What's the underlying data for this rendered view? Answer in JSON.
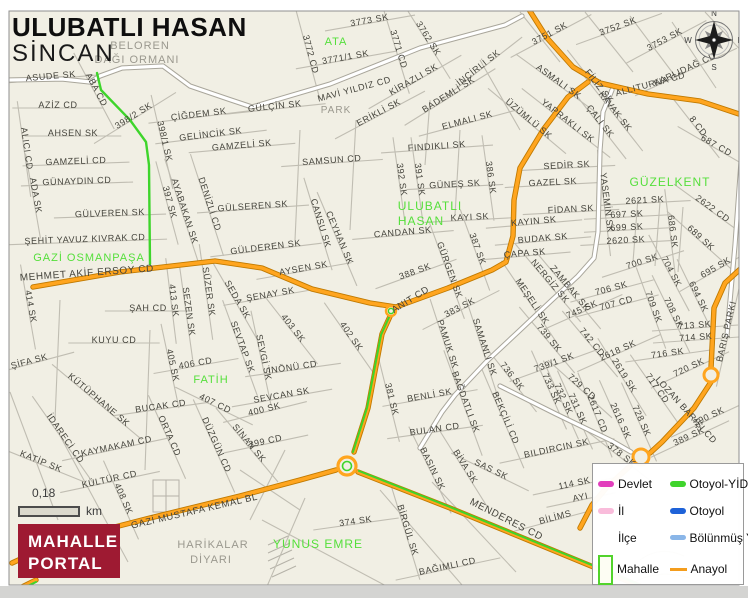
{
  "header": {
    "title": "ULUBATLI HASAN",
    "district": "SİNCAN"
  },
  "scalebar": {
    "distance": "0,18",
    "unit": "km"
  },
  "logo": {
    "line1": "MAHALLE",
    "line2": "PORTAL",
    "background": "#9e1a32"
  },
  "compass": {
    "north": "N",
    "east": "E",
    "south": "S",
    "west": "W"
  },
  "legend": {
    "items": [
      {
        "label": "Devlet",
        "color": "#e23ebc"
      },
      {
        "label": "Otoyol-YİD",
        "color": "#3fd42c"
      },
      {
        "label": "İl",
        "color": "#f9bcdb"
      },
      {
        "label": "Otoyol",
        "color": "#1e62d8"
      },
      {
        "label": "İlçe",
        "color": "#ffffff"
      },
      {
        "label": "Bölünmüş Y",
        "color": "#8ab6e8"
      },
      {
        "label": "Mahalle",
        "color": "#52d32c"
      },
      {
        "label": "Anayol",
        "color": "#f49d1d"
      }
    ]
  },
  "map": {
    "colors": {
      "background": "#f1efe4",
      "street": "#c0bdb2",
      "road_main": "#ffa51f",
      "road_main_casing": "#c07a00",
      "road_yid": "#3ed52b",
      "road_white": "#ffffff",
      "road_white_casing": "#a9a69b",
      "label": "#45443c",
      "label_area": "#55df3b",
      "label_terrain": "#9a988e"
    },
    "labels": [
      {
        "t": "BELOREN",
        "x": 140,
        "y": 49,
        "k": "terrain",
        "s": 11
      },
      {
        "t": "DAĞI ORMANI",
        "x": 137,
        "y": 63,
        "k": "terrain",
        "s": 11
      },
      {
        "t": "3773 SK",
        "x": 370,
        "y": 23,
        "r": -10
      },
      {
        "t": "3772 CD",
        "x": 308,
        "y": 55,
        "r": 75
      },
      {
        "t": "ATA",
        "x": 336,
        "y": 45,
        "k": "area",
        "s": 11
      },
      {
        "t": "3771/1 SK",
        "x": 346,
        "y": 60,
        "r": -10
      },
      {
        "t": "3771 CD",
        "x": 396,
        "y": 50,
        "r": 73
      },
      {
        "t": "3762 SK",
        "x": 426,
        "y": 40,
        "r": 58
      },
      {
        "t": "3751 SK",
        "x": 551,
        "y": 36,
        "r": -28
      },
      {
        "t": "3752 SK",
        "x": 619,
        "y": 29,
        "r": -20
      },
      {
        "t": "3753 SK",
        "x": 666,
        "y": 42,
        "r": -28
      },
      {
        "t": "KARLIDAĞ CD",
        "x": 686,
        "y": 72,
        "r": -25
      },
      {
        "t": "ALLITURNA CD",
        "x": 651,
        "y": 87,
        "r": -15,
        "k": "road"
      },
      {
        "t": "ASUDE SK",
        "x": 51,
        "y": 79,
        "r": -5
      },
      {
        "t": "ABA CD",
        "x": 94,
        "y": 91,
        "r": 62
      },
      {
        "t": "MAVİ YILDIZ CD",
        "x": 355,
        "y": 92,
        "r": -15,
        "k": "road"
      },
      {
        "t": "KİRAZLI SK",
        "x": 415,
        "y": 82,
        "r": -30
      },
      {
        "t": "İNCİRLİ SK",
        "x": 480,
        "y": 70,
        "r": -38
      },
      {
        "t": "FİLİZ SK",
        "x": 597,
        "y": 88,
        "r": 52
      },
      {
        "t": "ASMALI SK",
        "x": 557,
        "y": 84,
        "r": 36
      },
      {
        "t": "AZİZ CD",
        "x": 58,
        "y": 108,
        "r": 0
      },
      {
        "t": "398/2 SK",
        "x": 135,
        "y": 118,
        "r": -32
      },
      {
        "t": "GÜLÇİN SK",
        "x": 275,
        "y": 109,
        "r": -6
      },
      {
        "t": "PARK",
        "x": 336,
        "y": 113,
        "k": "terrain",
        "s": 10
      },
      {
        "t": "ERİKLİ SK",
        "x": 380,
        "y": 115,
        "r": -28
      },
      {
        "t": "BADEMLİ SK",
        "x": 450,
        "y": 97,
        "r": -32
      },
      {
        "t": "ELMALI SK",
        "x": 468,
        "y": 123,
        "r": -15
      },
      {
        "t": "KAVAK SK",
        "x": 613,
        "y": 113,
        "r": 52
      },
      {
        "t": "ÇALI SK",
        "x": 598,
        "y": 123,
        "r": 52
      },
      {
        "t": "YAPRAKLI SK",
        "x": 566,
        "y": 123,
        "r": 38
      },
      {
        "t": "ÜZÜMLÜ SK",
        "x": 527,
        "y": 121,
        "r": 40
      },
      {
        "t": "8 CD",
        "x": 696,
        "y": 128,
        "r": 52
      },
      {
        "t": "687 CD",
        "x": 715,
        "y": 148,
        "r": 30
      },
      {
        "t": "AHSEN SK",
        "x": 73,
        "y": 136,
        "r": 0
      },
      {
        "t": "ÇİĞDEM SK",
        "x": 199,
        "y": 117,
        "r": -7
      },
      {
        "t": "GELİNCİK SK",
        "x": 211,
        "y": 137,
        "r": -7
      },
      {
        "t": "GAMZELİ SK",
        "x": 242,
        "y": 148,
        "r": -5
      },
      {
        "t": "ALICI CD",
        "x": 24,
        "y": 149,
        "r": 82
      },
      {
        "t": "398/1 SK",
        "x": 162,
        "y": 142,
        "r": 77
      },
      {
        "t": "GAMZELİ CD",
        "x": 76,
        "y": 164,
        "r": -2
      },
      {
        "t": "FINDIKLI SK",
        "x": 437,
        "y": 149,
        "r": -4
      },
      {
        "t": "SAMSUN CD",
        "x": 332,
        "y": 163,
        "r": -4
      },
      {
        "t": "GÜNAYDIN CD",
        "x": 77,
        "y": 184,
        "r": -2
      },
      {
        "t": "ADA SK",
        "x": 33,
        "y": 196,
        "r": 80
      },
      {
        "t": "SEDİR SK",
        "x": 567,
        "y": 168,
        "r": -3
      },
      {
        "t": "GAZEL SK",
        "x": 553,
        "y": 185,
        "r": -3
      },
      {
        "t": "GÜZELKENT",
        "x": 670,
        "y": 186,
        "k": "area",
        "s": 12
      },
      {
        "t": "392 SK",
        "x": 399,
        "y": 180,
        "r": 82
      },
      {
        "t": "391 SK",
        "x": 417,
        "y": 180,
        "r": 82
      },
      {
        "t": "GÜNEŞ SK",
        "x": 455,
        "y": 187,
        "r": -3
      },
      {
        "t": "386 SK",
        "x": 488,
        "y": 178,
        "r": 82
      },
      {
        "t": "GÜLVEREN SK",
        "x": 110,
        "y": 216,
        "r": -2
      },
      {
        "t": "397 SK",
        "x": 167,
        "y": 203,
        "r": 75
      },
      {
        "t": "AYABAKAN SK",
        "x": 182,
        "y": 212,
        "r": 72
      },
      {
        "t": "DENİZLİ CD",
        "x": 207,
        "y": 205,
        "r": 72
      },
      {
        "t": "GÜLSEREN SK",
        "x": 253,
        "y": 209,
        "r": -4
      },
      {
        "t": "YASEMİN SK",
        "x": 604,
        "y": 203,
        "r": 83
      },
      {
        "t": "2621 SK",
        "x": 645,
        "y": 203,
        "r": -3
      },
      {
        "t": "2622 CD",
        "x": 711,
        "y": 211,
        "r": 36
      },
      {
        "t": "FİDAN SK",
        "x": 571,
        "y": 212,
        "r": -3
      },
      {
        "t": "697 SK",
        "x": 627,
        "y": 217,
        "r": -3
      },
      {
        "t": "699 SK",
        "x": 627,
        "y": 230,
        "r": -3
      },
      {
        "t": "686 SK",
        "x": 670,
        "y": 232,
        "r": 83
      },
      {
        "t": "689 SK",
        "x": 699,
        "y": 240,
        "r": 42
      },
      {
        "t": "ULUBATLI",
        "x": 430,
        "y": 210,
        "k": "area",
        "s": 12
      },
      {
        "t": "HASAN",
        "x": 421,
        "y": 225,
        "k": "area",
        "s": 12
      },
      {
        "t": "KAYI SK",
        "x": 470,
        "y": 220,
        "r": -3
      },
      {
        "t": "CANSU SK",
        "x": 318,
        "y": 224,
        "r": 73
      },
      {
        "t": "CEYHAN SK",
        "x": 337,
        "y": 239,
        "r": 67
      },
      {
        "t": "CANDAN SK",
        "x": 403,
        "y": 235,
        "r": -5
      },
      {
        "t": "KAYIN SK",
        "x": 534,
        "y": 224,
        "r": -5
      },
      {
        "t": "2620 SK",
        "x": 626,
        "y": 243,
        "r": -3
      },
      {
        "t": "BUDAK SK",
        "x": 543,
        "y": 241,
        "r": -5
      },
      {
        "t": "ŞEHİT YAVUZ KIVRAK CD",
        "x": 85,
        "y": 242,
        "r": -2
      },
      {
        "t": "ÇAPA SK",
        "x": 525,
        "y": 256,
        "r": -5
      },
      {
        "t": "700 SK",
        "x": 643,
        "y": 264,
        "r": -18
      },
      {
        "t": "695 SK",
        "x": 717,
        "y": 270,
        "r": -30
      },
      {
        "t": "704 SK",
        "x": 669,
        "y": 273,
        "r": 62
      },
      {
        "t": "GAZİ OSMANPAŞA",
        "x": 89,
        "y": 261,
        "k": "area",
        "s": 11
      },
      {
        "t": "MEHMET AKİF ERSOY CD",
        "x": 87,
        "y": 276,
        "r": -4,
        "k": "road",
        "s": 10
      },
      {
        "t": "GÜLDEREN SK",
        "x": 266,
        "y": 250,
        "r": -7
      },
      {
        "t": "GÜRGEN SK",
        "x": 447,
        "y": 271,
        "r": 70
      },
      {
        "t": "387 SK",
        "x": 475,
        "y": 250,
        "r": 70
      },
      {
        "t": "388 SK",
        "x": 416,
        "y": 274,
        "r": -20
      },
      {
        "t": "MEŞELİ SK",
        "x": 530,
        "y": 303,
        "r": 56
      },
      {
        "t": "NERGİZ SK",
        "x": 548,
        "y": 283,
        "r": 50
      },
      {
        "t": "ZAMBAK SK",
        "x": 568,
        "y": 290,
        "r": 50
      },
      {
        "t": "706 SK",
        "x": 612,
        "y": 291,
        "r": -15
      },
      {
        "t": "707 CD",
        "x": 617,
        "y": 306,
        "r": -15
      },
      {
        "t": "745 SK",
        "x": 583,
        "y": 312,
        "r": -24
      },
      {
        "t": "709 SK",
        "x": 651,
        "y": 308,
        "r": 70
      },
      {
        "t": "708 SK",
        "x": 671,
        "y": 314,
        "r": 64
      },
      {
        "t": "694 SK",
        "x": 696,
        "y": 298,
        "r": 64
      },
      {
        "t": "AYSEN SK",
        "x": 304,
        "y": 271,
        "r": -10
      },
      {
        "t": "ANIT CD",
        "x": 412,
        "y": 302,
        "r": -32,
        "k": "road",
        "s": 9.5
      },
      {
        "t": "414 SK",
        "x": 28,
        "y": 307,
        "r": 80
      },
      {
        "t": "ŞAH CD",
        "x": 148,
        "y": 311,
        "r": 0
      },
      {
        "t": "413 SK",
        "x": 171,
        "y": 301,
        "r": 83
      },
      {
        "t": "SEZEN SK",
        "x": 186,
        "y": 312,
        "r": 82
      },
      {
        "t": "SÜZER SK",
        "x": 206,
        "y": 292,
        "r": 82
      },
      {
        "t": "SEDA SK",
        "x": 235,
        "y": 301,
        "r": 60
      },
      {
        "t": "ŞENAY SK",
        "x": 271,
        "y": 297,
        "r": -10
      },
      {
        "t": "403 SK",
        "x": 291,
        "y": 330,
        "r": 52
      },
      {
        "t": "402 SK",
        "x": 349,
        "y": 338,
        "r": 55
      },
      {
        "t": "BARIŞ PARKI",
        "x": 729,
        "y": 332,
        "r": -77
      },
      {
        "t": "713 SK",
        "x": 695,
        "y": 328,
        "r": -4
      },
      {
        "t": "714 SK",
        "x": 696,
        "y": 340,
        "r": -4
      },
      {
        "t": "716 SK",
        "x": 668,
        "y": 356,
        "r": -8
      },
      {
        "t": "720 SK",
        "x": 690,
        "y": 370,
        "r": -25
      },
      {
        "t": "KUYU CD",
        "x": 114,
        "y": 343,
        "r": 0
      },
      {
        "t": "ŞİFA SK",
        "x": 30,
        "y": 364,
        "r": -15
      },
      {
        "t": "PAMUK SK",
        "x": 445,
        "y": 345,
        "r": 72
      },
      {
        "t": "SAMANLI SK",
        "x": 482,
        "y": 348,
        "r": 72
      },
      {
        "t": "383 SK",
        "x": 461,
        "y": 310,
        "r": -27
      },
      {
        "t": "381 SK",
        "x": 389,
        "y": 400,
        "r": 76
      },
      {
        "t": "739 SK",
        "x": 547,
        "y": 340,
        "r": 50
      },
      {
        "t": "742 CD",
        "x": 590,
        "y": 344,
        "r": 50
      },
      {
        "t": "2618 SK",
        "x": 619,
        "y": 353,
        "r": -24
      },
      {
        "t": "2619 SK",
        "x": 622,
        "y": 377,
        "r": 58
      },
      {
        "t": "739/1 SK",
        "x": 555,
        "y": 365,
        "r": -20
      },
      {
        "t": "736 SK",
        "x": 510,
        "y": 378,
        "r": 52
      },
      {
        "t": "733 SK",
        "x": 549,
        "y": 390,
        "r": 66
      },
      {
        "t": "732 SK",
        "x": 561,
        "y": 400,
        "r": 66
      },
      {
        "t": "731 SK",
        "x": 575,
        "y": 410,
        "r": 66
      },
      {
        "t": "729 CD",
        "x": 580,
        "y": 389,
        "r": 42
      },
      {
        "t": "2617 CD",
        "x": 595,
        "y": 415,
        "r": 68
      },
      {
        "t": "2616 SK",
        "x": 618,
        "y": 422,
        "r": 66
      },
      {
        "t": "728 SK",
        "x": 639,
        "y": 422,
        "r": 66
      },
      {
        "t": "717 CD",
        "x": 655,
        "y": 390,
        "r": 55
      },
      {
        "t": "LOZAN BARIŞI CD",
        "x": 684,
        "y": 412,
        "r": 48,
        "k": "road"
      },
      {
        "t": "390 SK",
        "x": 710,
        "y": 419,
        "r": -25
      },
      {
        "t": "389 SK",
        "x": 690,
        "y": 439,
        "r": -25
      },
      {
        "t": "405 SK",
        "x": 170,
        "y": 366,
        "r": 78
      },
      {
        "t": "406 CD",
        "x": 196,
        "y": 366,
        "r": -10
      },
      {
        "t": "FATİH",
        "x": 211,
        "y": 383,
        "k": "area",
        "s": 11
      },
      {
        "t": "SEVTAP SK",
        "x": 240,
        "y": 348,
        "r": 70
      },
      {
        "t": "SEVGİ SK",
        "x": 261,
        "y": 358,
        "r": 78
      },
      {
        "t": "İNÖNÜ CD",
        "x": 293,
        "y": 370,
        "r": -8
      },
      {
        "t": "KÜTÜPHANE SK",
        "x": 97,
        "y": 402,
        "r": 40
      },
      {
        "t": "BUCAK CD",
        "x": 161,
        "y": 409,
        "r": -8
      },
      {
        "t": "407 CD",
        "x": 214,
        "y": 406,
        "r": 26
      },
      {
        "t": "SEVCAN SK",
        "x": 282,
        "y": 398,
        "r": -10
      },
      {
        "t": "400 SK",
        "x": 265,
        "y": 412,
        "r": -14
      },
      {
        "t": "BENLİ SK",
        "x": 430,
        "y": 398,
        "r": -10
      },
      {
        "t": "BAĞDATLI SK",
        "x": 463,
        "y": 403,
        "r": 70
      },
      {
        "t": "BEKÇİLİ CD",
        "x": 503,
        "y": 419,
        "r": 67
      },
      {
        "t": "İDARECİ CD",
        "x": 63,
        "y": 440,
        "r": 55
      },
      {
        "t": "ORTA CD",
        "x": 167,
        "y": 437,
        "r": 66
      },
      {
        "t": "DÜZGÜN CD",
        "x": 214,
        "y": 446,
        "r": 66
      },
      {
        "t": "SİNAN SK",
        "x": 247,
        "y": 445,
        "r": 50
      },
      {
        "t": "KAYMAKAM CD",
        "x": 117,
        "y": 449,
        "r": -12
      },
      {
        "t": "KATİP SK",
        "x": 40,
        "y": 464,
        "r": 22
      },
      {
        "t": "399 CD",
        "x": 266,
        "y": 444,
        "r": -12
      },
      {
        "t": "BULAN CD",
        "x": 435,
        "y": 432,
        "r": -8
      },
      {
        "t": "BILDIRCIN SK",
        "x": 557,
        "y": 451,
        "r": -12
      },
      {
        "t": "378 SK",
        "x": 620,
        "y": 457,
        "r": 38
      },
      {
        "t": "BASIN SK",
        "x": 430,
        "y": 470,
        "r": 64
      },
      {
        "t": "BİVA SK",
        "x": 463,
        "y": 468,
        "r": 58
      },
      {
        "t": "SAS SK",
        "x": 490,
        "y": 472,
        "r": 26
      },
      {
        "t": "KÜLTÜR CD",
        "x": 110,
        "y": 482,
        "r": -12
      },
      {
        "t": "114 SK",
        "x": 575,
        "y": 486,
        "r": -12
      },
      {
        "t": "AYI",
        "x": 581,
        "y": 500,
        "r": -12
      },
      {
        "t": "408 SK",
        "x": 121,
        "y": 500,
        "r": 66
      },
      {
        "t": "GAZİ MUSTAFA KEMAL BL",
        "x": 195,
        "y": 514,
        "r": -13,
        "k": "road",
        "s": 9.5
      },
      {
        "t": "BİLİMS",
        "x": 556,
        "y": 520,
        "r": -15
      },
      {
        "t": "374 SK",
        "x": 356,
        "y": 524,
        "r": -8
      },
      {
        "t": "BİRGÜL SK",
        "x": 405,
        "y": 531,
        "r": 73
      },
      {
        "t": "MENDERES CD",
        "x": 505,
        "y": 522,
        "r": 27,
        "k": "road",
        "s": 10
      },
      {
        "t": "YUNUS EMRE",
        "x": 318,
        "y": 548,
        "k": "area",
        "s": 12
      },
      {
        "t": "HARİKALAR",
        "x": 213,
        "y": 548,
        "k": "terrain",
        "s": 11
      },
      {
        "t": "DİYARI",
        "x": 211,
        "y": 563,
        "k": "terrain",
        "s": 11
      },
      {
        "t": "BAĞIMLI CD",
        "x": 448,
        "y": 569,
        "r": -12
      }
    ]
  }
}
